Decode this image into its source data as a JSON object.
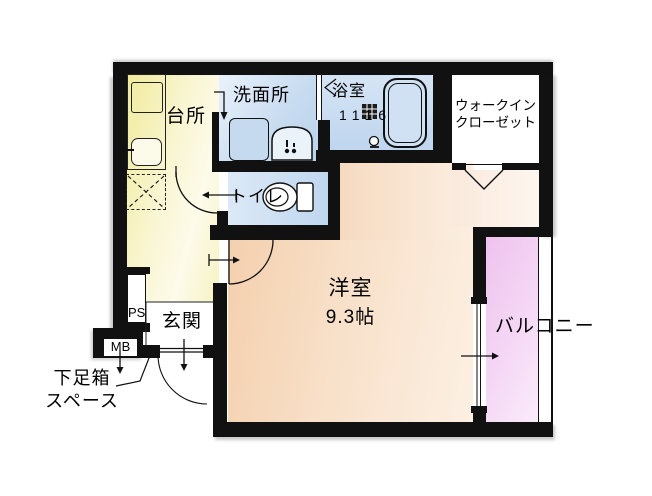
{
  "plan": {
    "rooms": {
      "kitchen": {
        "label": "台所"
      },
      "washroom": {
        "label": "洗面所"
      },
      "bathroom": {
        "label": "浴室",
        "size": "1116"
      },
      "walk_in_closet": {
        "label_line1": "ウォークイン",
        "label_line2": "クローゼット"
      },
      "toilet": {
        "label": "トイレ"
      },
      "main_room": {
        "label": "洋室",
        "size": "9.3帖"
      },
      "balcony": {
        "label": "バルコニー"
      },
      "entrance": {
        "label": "玄関"
      },
      "pipe_space": {
        "label": "PS"
      },
      "meter_box": {
        "label": "MB"
      },
      "shoe_box": {
        "label_line1": "下足箱",
        "label_line2": "スペース"
      }
    },
    "colors": {
      "wall": "#111111",
      "kitchen_yellow": "#F2EC9F",
      "wet_area_blue": "#C4D9EF",
      "main_room_peach": "#F4D0AE",
      "balcony_pink": "#EEC2EE",
      "closet_white": "#FFFFFF"
    }
  }
}
